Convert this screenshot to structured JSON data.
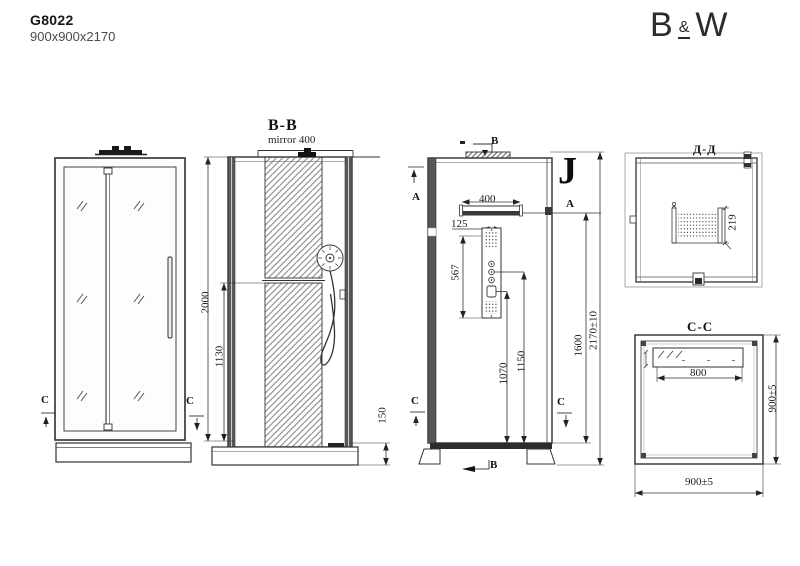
{
  "header": {
    "model": "G8022",
    "size": "900x900x2170"
  },
  "logo": {
    "b": "B",
    "amp": "&",
    "w": "W"
  },
  "front_view": {
    "section_left": "C",
    "section_right": "C"
  },
  "section_bb": {
    "title": "B-B",
    "mirror_label": "mirror 400",
    "dim_height": "2000",
    "dim_mirror_height": "1130",
    "dim_tray_height": "150"
  },
  "side_view": {
    "door_mark": "J",
    "a_left": "A",
    "a_right": "A",
    "b_top": "B",
    "b_bottom": "B",
    "c_left": "C",
    "c_right": "C",
    "dim_shelf_width": "400",
    "dim_panel_width": "125",
    "dim_panel_height": "567",
    "dim_control_1": "1070",
    "dim_control_2": "1150",
    "dim_inner_height": "1600",
    "dim_total_height": "2170±10"
  },
  "section_dd": {
    "title": "Д-Д",
    "dim_panel_depth": "219"
  },
  "section_cc": {
    "title": "C-C",
    "dim_width": "900±5",
    "dim_depth": "900±5",
    "dim_mirror_width": "800"
  }
}
